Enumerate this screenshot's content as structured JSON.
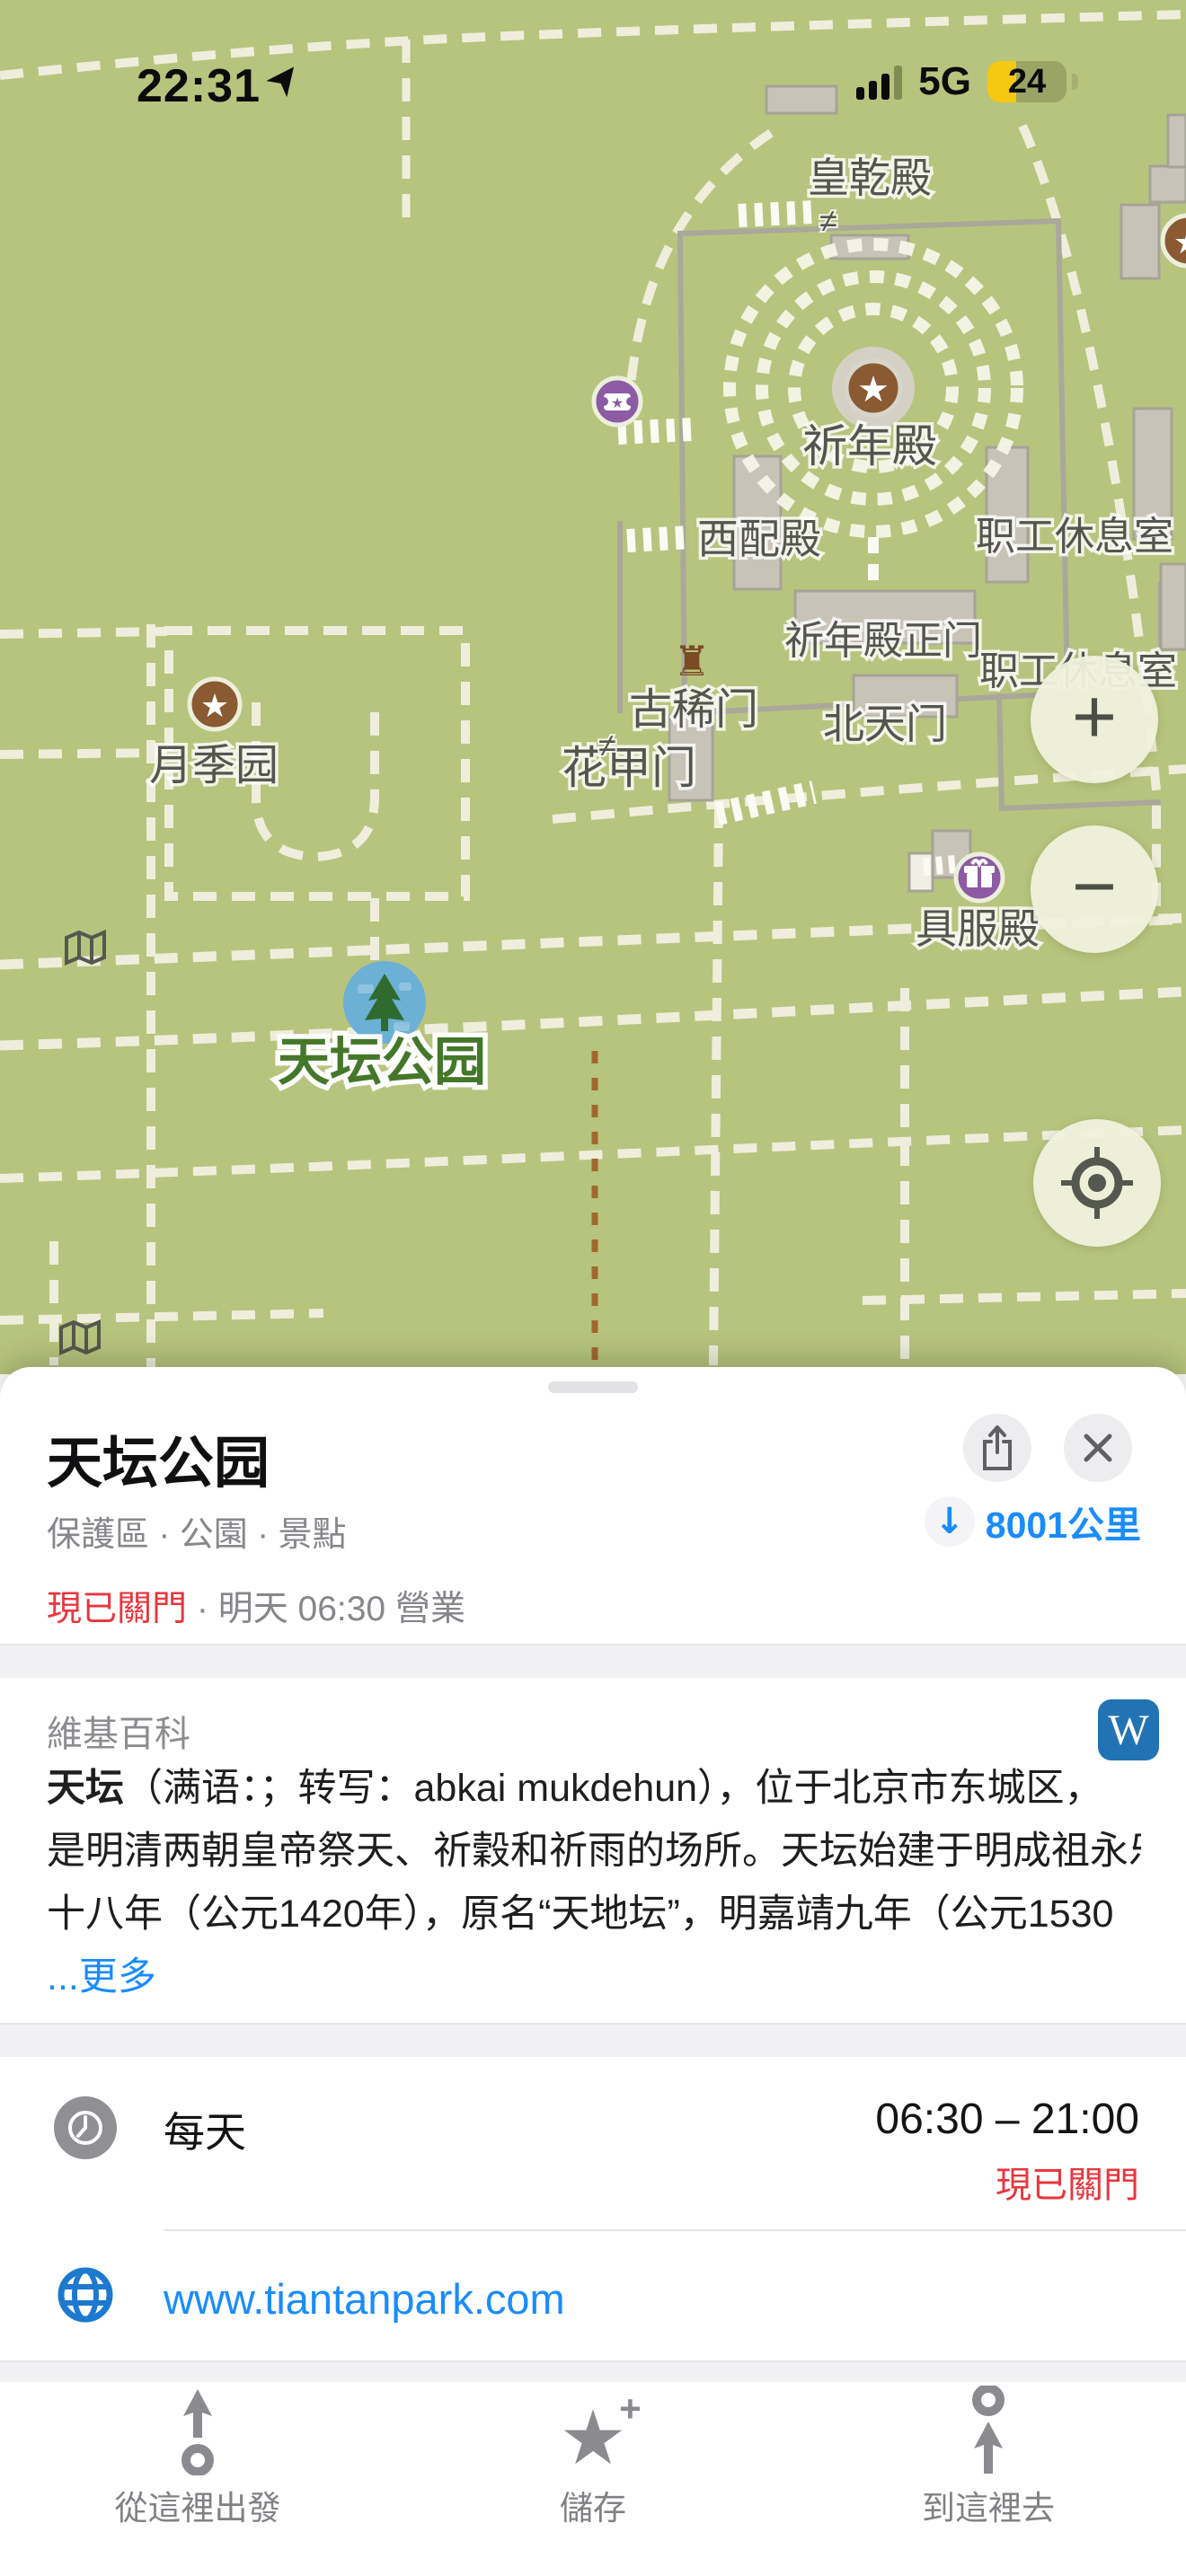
{
  "status_bar": {
    "time": "22:31",
    "network": "5G",
    "battery_percent": "24"
  },
  "map": {
    "labels": {
      "huangqiandian": "皇乾殿",
      "qiniandian": "祈年殿",
      "xipeidian": "西配殿",
      "staff_room_1": "职工休息室",
      "qiniandian_gate": "祈年殿正门",
      "staff_room_2": "职工休息室",
      "guximen": "古稀门",
      "beitianmen": "北天门",
      "huajiamen": "花甲门",
      "yuejiyuan": "月季园",
      "jufudian": "具服殿",
      "park": "天坛公园",
      "gate_marker_1": "≠",
      "gate_marker_2": "≠"
    },
    "colors": {
      "background": "#b7c47d",
      "path": "#efeedd",
      "poi_brown": "#8a5a33",
      "poi_purple": "#8d5ba5",
      "pin_blue": "#6cb0d5",
      "park_label_green": "#45772a"
    }
  },
  "controls": {
    "zoom_in": "+",
    "zoom_out": "−"
  },
  "sheet": {
    "title": "天坛公园",
    "category": "保護區 · 公園 · 景點",
    "distance": "8001公里",
    "distance_arrow": "↓",
    "closed_label": "現已關門",
    "dot": " · ",
    "open_info": "明天 06:30 營業",
    "wikipedia": {
      "header": "維基百科",
      "logo_letter": "W",
      "lead": "天坛",
      "line1": "（满语：；转写：abkai mukdehun），位于北京市东城区，",
      "line2": "是明清两朝皇帝祭天、祈穀和祈雨的场所。天坛始建于明成祖永乐",
      "line3": "十八年（公元1420年），原名“天地坛”，明嘉靖九年（公元1530",
      "more_link": "...更多"
    },
    "hours": {
      "label": "每天",
      "time": "06:30 – 21:00",
      "status": "現已關門"
    },
    "website": {
      "url": "www.tiantanpark.com"
    }
  },
  "toolbar": {
    "from_here": "從這裡出發",
    "save": "儲存",
    "to_here": "到這裡去"
  }
}
